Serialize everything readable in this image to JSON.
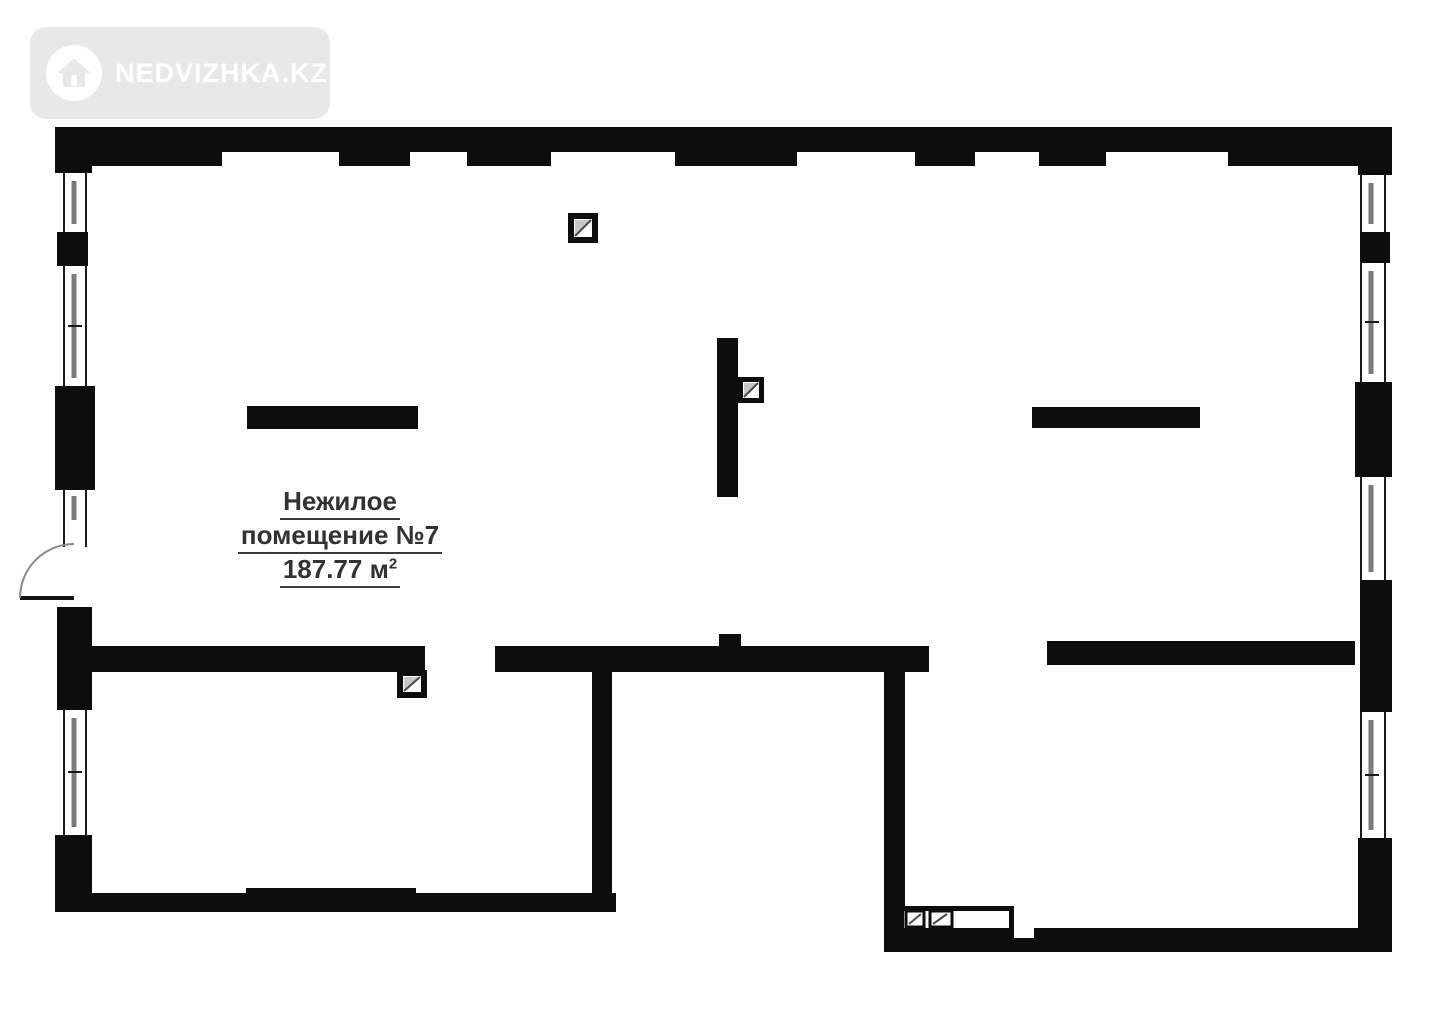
{
  "page": {
    "background": "#ffffff"
  },
  "watermark": {
    "brand": "NEDVIZHKA.KZ",
    "badge_color": "#e8e8e8",
    "text_color": "#ffffff",
    "icon": "house-icon"
  },
  "plan": {
    "room_label_line1": "Нежилое",
    "room_label_line2": "помещение №7",
    "area_value": "187.77",
    "area_unit": " м",
    "area_exponent": "2",
    "wall_color": "#0d0d0d",
    "label_color": "#323232",
    "window_sash_color": "#7a7a7a",
    "symbols": [
      "vent-duct-square",
      "entrance-door-swing"
    ]
  }
}
